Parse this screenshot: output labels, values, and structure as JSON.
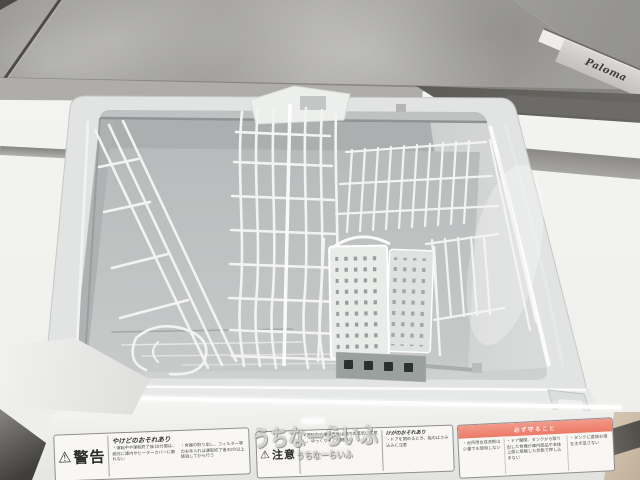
{
  "watermarks": {
    "large": "うちなーらいふ",
    "small": "うちなーらいふ"
  },
  "cooktop": {
    "logo": "Paloma"
  },
  "labels": {
    "warning": {
      "symbol": "⚠",
      "heading": "警告",
      "title": "やけどのおそれあり",
      "bullets": [
        "・運転中や運転終了後30分間は、絶対に庫内やヒーターカバーに触れない",
        "・食器の取り出し、フィルター等のお手入れは運転終了後30分以上経過してから行う"
      ]
    },
    "caution": {
      "symbol": "⚠",
      "heading": "注意",
      "bullets": [
        "・運転中や運転直後は庫内の蒸気に注意し、ゆっくりドアを開ける"
      ],
      "sub_title": "けがのおそれあり",
      "sub_bullets": [
        "・ドアを閉めるとき、指のはさみ込みに注意"
      ]
    },
    "notice": {
      "header": "必ず守ること",
      "bullets": [
        "・台所用合成洗剤は少量でも使用しない",
        "・ドア開閉、タンクから取り出した食器が庫内部品や本体上部に接触した状態で押し込まない",
        "・タンクに直接お湯を注ぎ足さない"
      ]
    }
  },
  "colors": {
    "counter_gray": "#a2a19e",
    "tub_gray": "#c9cccb",
    "rack_white": "#f4f5f3",
    "panel_white": "#f2f2f0",
    "notice_band_red": "#ee8472",
    "floor_beige": "#cfc0ac"
  }
}
